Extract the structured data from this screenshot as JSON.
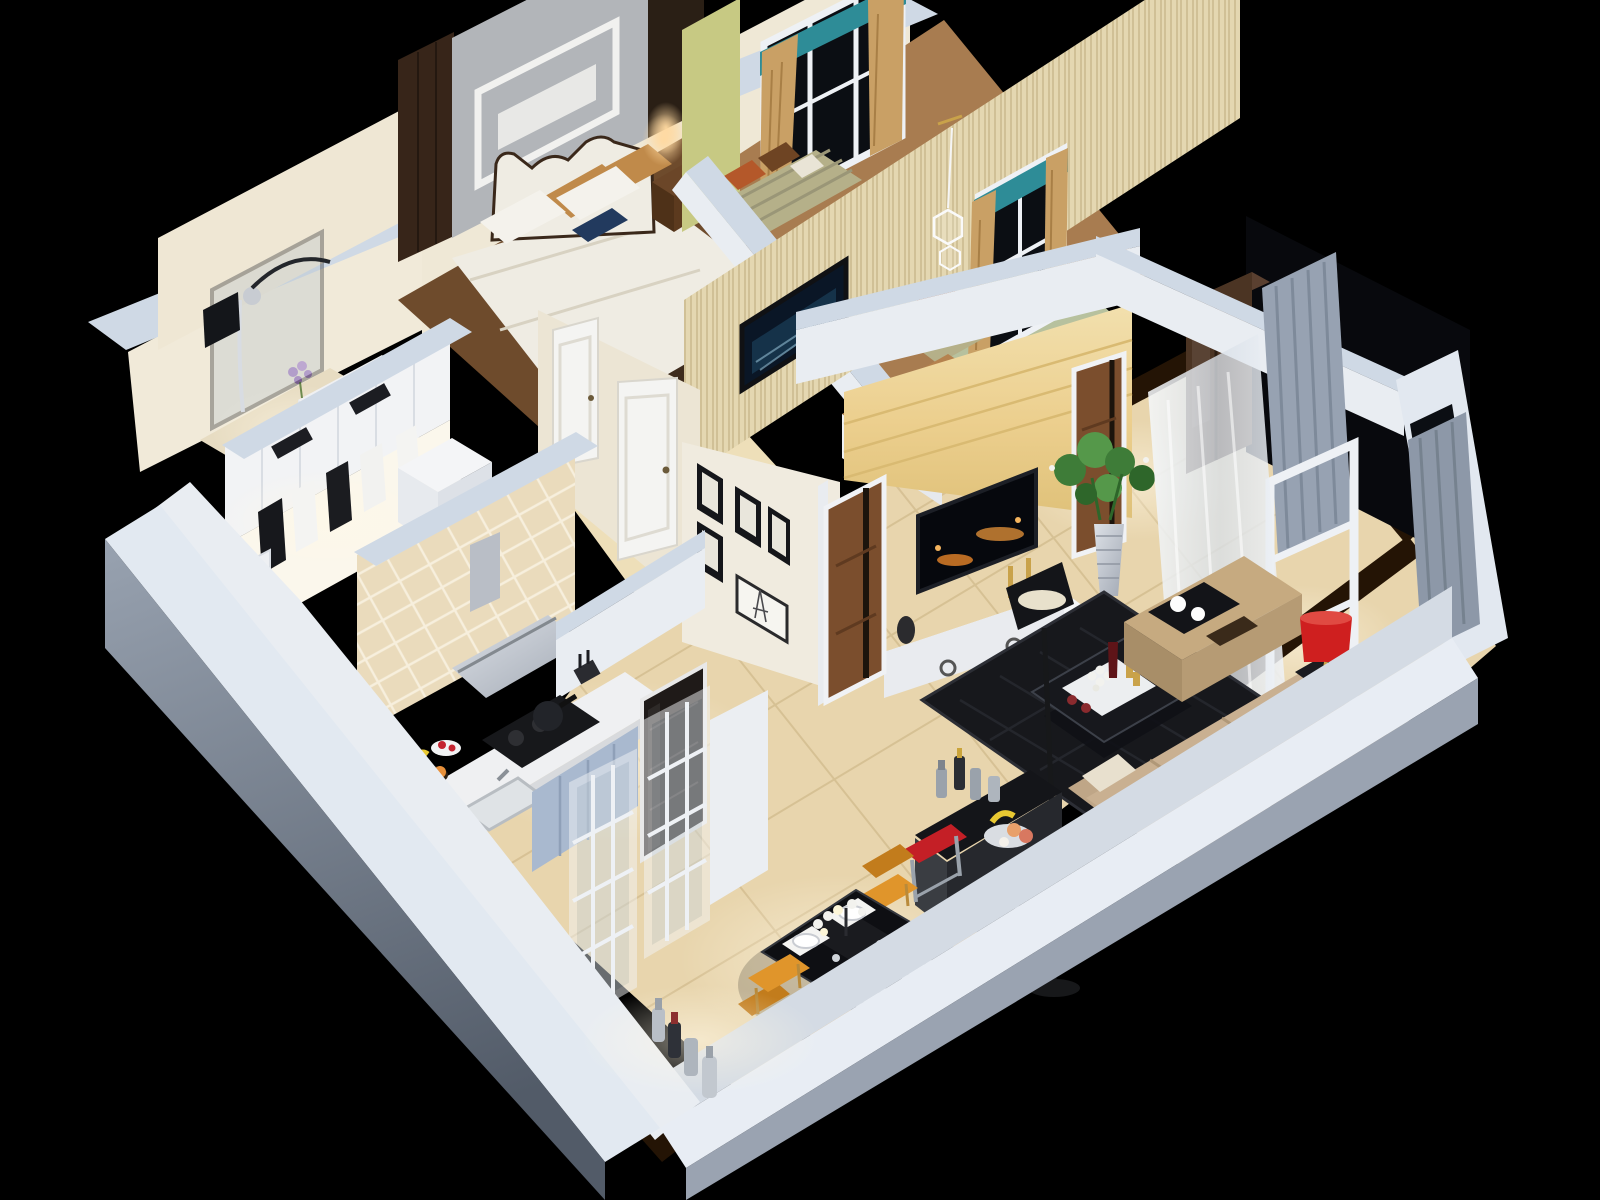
{
  "scene": {
    "title": "3D cutaway render of an apartment floor plan viewed from above at night",
    "style": "photorealistic dollhouse axonometric render on black background"
  },
  "palette": {
    "bg": "#000000",
    "wallTop": "#cfd9e5",
    "wallFace": "#e9edf2",
    "wallCream": "#efe8d6",
    "outerGreyA": "#98a2b0",
    "outerGreyB": "#525b68",
    "floorBeige": "#e8d5ad",
    "grout": "#c9b181",
    "inlayDark": "#241405",
    "floorWoodDark": "#6e4b2c",
    "floorWoodMid": "#a87c50",
    "rugSage": "#b7c19e",
    "rugDark": "#17181c",
    "tileWall": "#eadbbc",
    "marbleA": "#f2e0ae",
    "marbleB": "#dfc179",
    "counterWhite": "#eff0f2",
    "cabinetBlue": "#a9b9cf",
    "steel": "#c6cbd3",
    "greyAccent": "#b2b5b9",
    "yellowGreen": "#c7c983",
    "woodGrainWall": "#e4d7b1",
    "curtainTan": "#c9a065",
    "valanceTeal": "#2e8c97",
    "curtainGrey": "#97a2b2",
    "sheerWhite": "#e9edf2",
    "windowDark": "#0b0e13",
    "doorBrown": "#7b4e2d",
    "wardrobeDark": "#4b3423",
    "darkWood": "#372519",
    "bedWhite": "#efece3",
    "pillowGold": "#c08a4a",
    "sofaBeige": "#c9b091",
    "sofaShade": "#ab9171",
    "chairOrange": "#e0952b",
    "stoolRed": "#c41f26",
    "lampRed": "#cf1f1f",
    "plantGreen": "#3e7c38",
    "tvGlowOrange": "#e8943a",
    "glowWarm": "#ffd9a0",
    "lightPool": "#fff8e6"
  },
  "rooms": [
    {
      "id": "master-bedroom",
      "name": "Master bedroom",
      "items": [
        "white tufted bed",
        "gold pillows",
        "dark wood nightstand",
        "warm wall lamp",
        "dark wardrobe",
        "grey accent wall with white molding",
        "bay window seat",
        "tan curtains with teal valance"
      ]
    },
    {
      "id": "second-bedroom",
      "name": "Second bedroom",
      "items": [
        "wood-grain wallpaper wall",
        "wall-mounted TV",
        "white birdcage pendant",
        "bay window seats with striped cushions",
        "orange pillows",
        "desk",
        "tea set shelf"
      ]
    },
    {
      "id": "bathroom",
      "name": "Bathroom",
      "items": [
        "glass shower with black frame",
        "chrome shower column",
        "black towel",
        "white vanity",
        "lavender flowers",
        "toilet"
      ]
    },
    {
      "id": "walk-in-closet",
      "name": "Walk-in closet",
      "items": [
        "white upper cabinets",
        "hanging black and white clothes",
        "island dresser"
      ]
    },
    {
      "id": "kitchen",
      "name": "Kitchen",
      "items": [
        "beige tiled wall",
        "stainless range hood",
        "black gas cooktop",
        "terrazzo counter",
        "blue-grey cabinets",
        "sink",
        "fruit plate",
        "built-in dark fridge"
      ]
    },
    {
      "id": "corridor",
      "name": "Corridor",
      "items": [
        "white paneled doors",
        "gallery wall with black picture frames",
        "Eiffel tower sketch frame"
      ]
    },
    {
      "id": "living-room",
      "name": "Living room",
      "items": [
        "yellow marble TV wall",
        "flat TV with night city image",
        "white media console",
        "tall silver vase with plant",
        "black floor lamp",
        "dark rug",
        "glass coffee table with flowers and wine",
        "beige sectional sofa with pillows",
        "ottoman with tea tray",
        "red drum table lamp",
        "black bar counter with bottles and fruit bowl",
        "two red bar stools"
      ]
    },
    {
      "id": "dining-room",
      "name": "Dining room",
      "items": [
        "black dining table",
        "white place settings",
        "flower centerpiece",
        "four orange chairs",
        "white grid sliding doors",
        "bottles on wall ledge"
      ]
    },
    {
      "id": "entry-hall",
      "name": "Entry hall",
      "items": [
        "dark brown wardrobe",
        "marble floor with dark inlay"
      ]
    },
    {
      "id": "balcony",
      "name": "Balcony",
      "items": [
        "grey curtains",
        "white sheer curtain",
        "white sliding door frame",
        "dark window openings"
      ]
    }
  ]
}
